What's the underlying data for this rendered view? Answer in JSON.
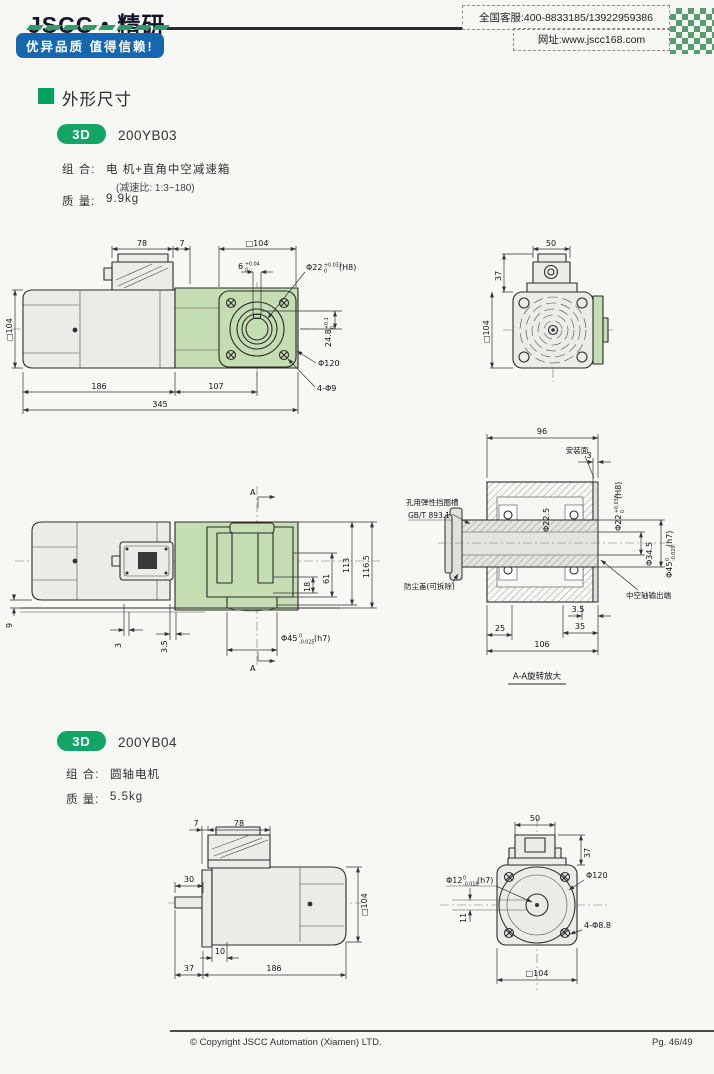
{
  "header": {
    "logo": "JSCC・精研",
    "slogan": "优异品质 值得信赖!",
    "hotline": "全国客服:400-8833185/13922959386",
    "website": "网址:www.jscc168.com"
  },
  "section": {
    "title": "外形尺寸"
  },
  "models": [
    {
      "badge": "3D",
      "name": "200YB03",
      "combo_label": "组 合:",
      "combo_value": "电 机+直角中空减速箱",
      "ratio_note": "(减速比: 1:3~180)",
      "mass_label": "质 量:",
      "mass_value": "9.9kg"
    },
    {
      "badge": "3D",
      "name": "200YB04",
      "combo_label": "组 合:",
      "combo_value": "圆轴电机",
      "mass_label": "质 量:",
      "mass_value": "5.5kg"
    }
  ],
  "yb03_side": {
    "d78": "78",
    "d7": "7",
    "sq104_top": "□104",
    "key_w": "6",
    "key_w_sup": "+0.04",
    "key_w_sub": "0",
    "bore": "Φ22",
    "bore_sup": "+0.033",
    "bore_sub": "0",
    "bore_fit": "(H8)",
    "key_h": "24.8",
    "key_h_sup": "+0.1",
    "key_h_sub": "0",
    "flange_dia": "Φ120",
    "bolt_holes": "4-Φ9",
    "sq104_left": "□104",
    "d186": "186",
    "d107": "107",
    "d345": "345"
  },
  "yb03_rear": {
    "d50": "50",
    "d37": "37",
    "sq104": "□104"
  },
  "yb03_top": {
    "a_top": "A",
    "a_bottom": "A",
    "d113": "113",
    "d116_5": "116.5",
    "d18": "18",
    "d61": "61",
    "d9": "9",
    "d3": "3",
    "d3_5": "3.5",
    "shaft": "Φ45",
    "shaft_sup": "0",
    "shaft_sub": "-0.025",
    "shaft_fit": "(h7)"
  },
  "aa": {
    "d96": "96",
    "mount_face": "安装面",
    "d3": "3",
    "circlip1": "孔用弹性挡圈槽",
    "circlip2": "GB/T 893.1",
    "dust_cover": "防尘盖(可拆除)",
    "dia22_5": "Φ22.5",
    "bore": "Φ22",
    "bore_sup": "+0.033",
    "bore_sub": "0",
    "bore_fit": "(H8)",
    "dia34_5": "Φ34.5",
    "out": "Φ45",
    "out_sup": "0",
    "out_sub": "-0.025",
    "out_fit": "(h7)",
    "hollow": "中空轴输出端",
    "d3_5": "3.5",
    "d25": "25",
    "d35": "35",
    "d106": "106",
    "caption": "A-A旋转放大"
  },
  "yb04_side": {
    "d7": "7",
    "d78": "78",
    "d30": "30",
    "d10": "10",
    "d37": "37",
    "d186": "186",
    "sq104": "□104"
  },
  "yb04_front": {
    "d50": "50",
    "d37": "37",
    "shaft": "Φ12",
    "shaft_sup": "0",
    "shaft_sub": "-0.018",
    "shaft_fit": "(h7)",
    "flange_dia": "Φ120",
    "bolt_holes": "4-Φ8.8",
    "d11": "11",
    "sq104": "□104"
  },
  "footer": {
    "copyright": "© Copyright JSCC Automation (Xiamen) LTD.",
    "page": "Pg. 46/49"
  }
}
